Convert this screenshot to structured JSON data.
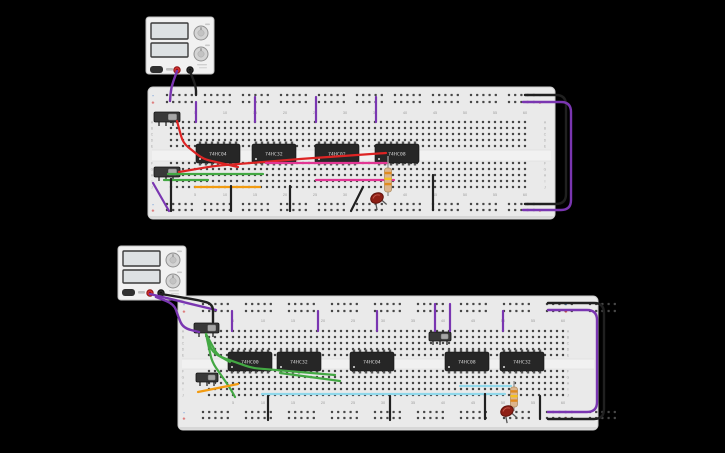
{
  "colors": {
    "background": "#000000",
    "board": "#eaeaea",
    "board_edge": "#cccccc",
    "board_shadow": "#d7d7d7",
    "hole": "#474747",
    "channel": "#f1f1f1",
    "channel_line": "#d8d8d8",
    "label_gray": "#9c9c9c",
    "letter_gray": "#a8a8a8",
    "rail_neg_blue": "#5b8fd6",
    "rail_pos_red": "#d64545",
    "ic_body": "#262626",
    "ic_pin": "#565656",
    "ic_text": "#dcdcdc",
    "switch_body": "#383838",
    "switch_slider": "#a6a6a6",
    "switch_pin": "#6a6a6a",
    "wire_purple": "#7a36b1",
    "wire_black": "#202020",
    "wire_red": "#dd2424",
    "wire_green": "#43a843",
    "wire_orange": "#f29b11",
    "wire_cyan": "#8fd7ea",
    "wire_magenta": "#e23694",
    "led_body": "#8e1f15",
    "led_stroke": "#5f120b",
    "led_shine": "#c05548",
    "resistor_body": "#dcb48c",
    "resistor_stroke": "#b08d5f",
    "band_orange": "#e08a1e",
    "band_yellow": "#f5c11e",
    "psu_body": "#f1f1f1",
    "psu_edge": "#c2c2c2",
    "psu_display": "#dde1e3",
    "psu_display_edge": "#3b3b3b",
    "psu_knob": "#d4d4d4",
    "psu_button": "#303030",
    "terminal_red": "#d32f2f",
    "terminal_black": "#2a2a2a"
  },
  "board_labels": {
    "columns": [
      5,
      10,
      15,
      20,
      25,
      30,
      35,
      40,
      45,
      50,
      55,
      60
    ],
    "rows": [
      "A",
      "B",
      "C",
      "D",
      "E",
      "F",
      "G",
      "H",
      "I",
      "J"
    ],
    "rail_negative": "-",
    "rail_positive": "+"
  },
  "power_supplies": [
    {
      "name": "power-supply-top",
      "x": 146,
      "y": 17,
      "w": 68,
      "h": 57,
      "displays": [
        {
          "x": 151,
          "y": 23,
          "w": 37,
          "h": 16
        },
        {
          "x": 151,
          "y": 43,
          "w": 37,
          "h": 14
        }
      ],
      "knobs": [
        {
          "cx": 201,
          "cy": 33,
          "r": 7
        },
        {
          "cx": 201,
          "cy": 54,
          "r": 7
        }
      ],
      "button": {
        "x": 150,
        "y": 66,
        "w": 13,
        "h": 7
      },
      "terminals": [
        {
          "cx": 177,
          "cy": 70,
          "type": "positive"
        },
        {
          "cx": 190,
          "cy": 70,
          "type": "negative"
        }
      ]
    },
    {
      "name": "power-supply-bottom",
      "x": 118,
      "y": 246,
      "w": 68,
      "h": 54,
      "displays": [
        {
          "x": 123,
          "y": 251,
          "w": 37,
          "h": 15
        },
        {
          "x": 123,
          "y": 270,
          "w": 37,
          "h": 13
        }
      ],
      "knobs": [
        {
          "cx": 173,
          "cy": 260,
          "r": 7
        },
        {
          "cx": 173,
          "cy": 281,
          "r": 7
        }
      ],
      "button": {
        "x": 122,
        "y": 289,
        "w": 13,
        "h": 7
      },
      "terminals": [
        {
          "cx": 150,
          "cy": 293,
          "type": "positive"
        },
        {
          "cx": 161,
          "cy": 293,
          "type": "negative"
        }
      ]
    }
  ],
  "breadboards": [
    {
      "name": "breadboard-top",
      "x": 148,
      "y": 87,
      "w": 407,
      "h": 132,
      "rail": {
        "x0": 167,
        "sp": 6.2,
        "gap": 7,
        "top_rows": [
          95,
          102
        ],
        "bottom_rows": [
          204,
          210
        ],
        "mark_left_x": 153,
        "mark_right_x": 540
      },
      "grid": {
        "x0": 171,
        "sp": 6,
        "cols": 60,
        "rows_top": [
          122,
          128,
          134,
          140,
          146
        ],
        "rows_bot": [
          163,
          169,
          175,
          181,
          187
        ],
        "num_y": [
          114,
          196
        ],
        "letters_x": [
          152,
          545
        ],
        "channel": [
          150,
          11
        ]
      },
      "ics": [
        {
          "label": "74HC04",
          "x": 196,
          "y": 144,
          "w": 44,
          "h": 19
        },
        {
          "label": "74HC32",
          "x": 252,
          "y": 144,
          "w": 44,
          "h": 19
        },
        {
          "label": "74HC02",
          "x": 315,
          "y": 144,
          "w": 44,
          "h": 19
        },
        {
          "label": "74HC08",
          "x": 375,
          "y": 144,
          "w": 44,
          "h": 19
        }
      ],
      "switches": [
        {
          "x": 154,
          "y": 112,
          "w": 26,
          "h": 10,
          "pins": [
            159,
            166,
            173
          ],
          "pin_y": 122
        },
        {
          "x": 154,
          "y": 167,
          "w": 26,
          "h": 10,
          "pins": [
            159,
            166,
            173
          ],
          "pin_y": 177
        }
      ],
      "leds": [
        {
          "cx": 377,
          "cy": 198,
          "rot": -25
        }
      ],
      "resistors": [
        {
          "x": 388,
          "lead_y1": 156,
          "lead_y2": 196,
          "body_y1": 168,
          "body_y2": 192
        }
      ]
    },
    {
      "name": "breadboard-bottom",
      "x": 178,
      "y": 296,
      "w": 420,
      "h": 134,
      "rail": {
        "x0": 203,
        "sp": 6.2,
        "gap": 12,
        "top_rows": [
          304,
          311
        ],
        "bottom_rows": [
          412,
          418
        ],
        "mark_left_x": 184,
        "mark_right_x": 566
      },
      "grid": {
        "x0": 209,
        "sp": 6,
        "cols": 60,
        "rows_top": [
          331,
          337,
          343,
          349,
          355
        ],
        "rows_bot": [
          371,
          377,
          383,
          389,
          395
        ],
        "num_y": [
          322,
          404
        ],
        "letters_x": [
          183,
          568
        ],
        "channel": [
          359,
          10
        ]
      },
      "ics": [
        {
          "label": "74HC00",
          "x": 228,
          "y": 352,
          "w": 44,
          "h": 19
        },
        {
          "label": "74HC32",
          "x": 277,
          "y": 352,
          "w": 44,
          "h": 19
        },
        {
          "label": "74HC04",
          "x": 350,
          "y": 352,
          "w": 44,
          "h": 19
        },
        {
          "label": "74HC08",
          "x": 445,
          "y": 352,
          "w": 44,
          "h": 19
        },
        {
          "label": "74HC32",
          "x": 500,
          "y": 352,
          "w": 44,
          "h": 19
        }
      ],
      "switches": [
        {
          "x": 194,
          "y": 323,
          "w": 25,
          "h": 10,
          "pins": [
            199,
            206,
            213
          ],
          "pin_y": 333
        },
        {
          "x": 196,
          "y": 373,
          "w": 22,
          "h": 9,
          "pins": [
            200,
            207,
            214
          ],
          "pin_y": 382
        },
        {
          "x": 429,
          "y": 332,
          "w": 22,
          "h": 9,
          "pins": [
            433,
            440,
            447
          ],
          "pin_y": 341
        }
      ],
      "leds": [
        {
          "cx": 507,
          "cy": 411,
          "rot": -25
        }
      ],
      "resistors": [
        {
          "x": 514,
          "lead_y1": 381,
          "lead_y2": 411,
          "body_y1": 387,
          "body_y2": 407
        }
      ]
    }
  ],
  "wires": [
    {
      "id": "psu1-positive",
      "color": "purple",
      "w": 2.4,
      "points": [
        [
          177,
          71
        ],
        [
          171,
          88
        ],
        [
          170,
          101
        ]
      ]
    },
    {
      "id": "psu1-negative",
      "color": "black",
      "w": 2.4,
      "points": [
        [
          190,
          71
        ],
        [
          196,
          87
        ],
        [
          196,
          95
        ]
      ]
    },
    {
      "id": "b1-rail-jumper-1",
      "color": "purple",
      "w": 2.2,
      "points": [
        [
          196,
          102
        ],
        [
          196,
          122
        ]
      ]
    },
    {
      "id": "b1-rail-jumper-2",
      "color": "purple",
      "w": 2.2,
      "points": [
        [
          255,
          97
        ],
        [
          255,
          122
        ]
      ]
    },
    {
      "id": "b1-rail-jumper-3",
      "color": "purple",
      "w": 2.2,
      "points": [
        [
          316,
          97
        ],
        [
          316,
          122
        ]
      ]
    },
    {
      "id": "b1-rail-jumper-4",
      "color": "purple",
      "w": 2.2,
      "points": [
        [
          376,
          97
        ],
        [
          376,
          122
        ]
      ]
    },
    {
      "id": "b1-red-1",
      "color": "red",
      "w": 2.2,
      "points": [
        [
          177,
          121
        ],
        [
          183,
          143
        ],
        [
          203,
          159
        ],
        [
          238,
          167
        ]
      ]
    },
    {
      "id": "b1-red-2",
      "color": "red",
      "w": 2.2,
      "points": [
        [
          179,
          172
        ],
        [
          214,
          166
        ],
        [
          300,
          159
        ],
        [
          386,
          153
        ]
      ]
    },
    {
      "id": "b1-magenta-1",
      "color": "magenta",
      "w": 2.2,
      "points": [
        [
          266,
          163
        ],
        [
          388,
          163
        ]
      ]
    },
    {
      "id": "b1-magenta-2",
      "color": "magenta",
      "w": 2.2,
      "points": [
        [
          316,
          180
        ],
        [
          394,
          180
        ]
      ]
    },
    {
      "id": "b1-green-1",
      "color": "green",
      "w": 2.2,
      "points": [
        [
          168,
          174
        ],
        [
          263,
          174
        ]
      ]
    },
    {
      "id": "b1-green-2",
      "color": "green",
      "w": 2.2,
      "points": [
        [
          164,
          180
        ],
        [
          208,
          180
        ]
      ]
    },
    {
      "id": "b1-orange",
      "color": "orange",
      "w": 2.2,
      "points": [
        [
          195,
          187
        ],
        [
          260,
          187
        ]
      ]
    },
    {
      "id": "b1-black-1",
      "color": "black",
      "w": 2.2,
      "points": [
        [
          171,
          179
        ],
        [
          171,
          211
        ]
      ]
    },
    {
      "id": "b1-black-2",
      "color": "black",
      "w": 2.2,
      "points": [
        [
          231,
          186
        ],
        [
          231,
          211
        ]
      ]
    },
    {
      "id": "b1-black-3",
      "color": "black",
      "w": 2.2,
      "points": [
        [
          290,
          186
        ],
        [
          290,
          211
        ]
      ]
    },
    {
      "id": "b1-black-4",
      "color": "black",
      "w": 2.2,
      "points": [
        [
          433,
          175
        ],
        [
          433,
          210
        ]
      ]
    },
    {
      "id": "b1-black-5",
      "color": "black",
      "w": 2.2,
      "points": [
        [
          363,
          187
        ],
        [
          351,
          211
        ]
      ]
    },
    {
      "id": "b1-purple-diag",
      "color": "purple",
      "w": 2.2,
      "points": [
        [
          153,
          183
        ],
        [
          169,
          211
        ]
      ]
    },
    {
      "id": "b1-wrap-black",
      "color": "black",
      "w": 2.4,
      "r": 10,
      "points": [
        [
          525,
          95
        ],
        [
          566,
          95
        ],
        [
          566,
          204
        ],
        [
          525,
          204
        ]
      ]
    },
    {
      "id": "b1-wrap-purple",
      "color": "purple",
      "w": 2.4,
      "r": 10,
      "points": [
        [
          523,
          102
        ],
        [
          571,
          102
        ],
        [
          571,
          210
        ],
        [
          523,
          210
        ]
      ]
    },
    {
      "id": "psu2-positive",
      "color": "purple",
      "w": 2.4,
      "points": [
        [
          150,
          294
        ],
        [
          183,
          302
        ],
        [
          216,
          310
        ]
      ]
    },
    {
      "id": "psu2-negative",
      "color": "black",
      "w": 2.4,
      "points": [
        [
          161,
          294
        ],
        [
          198,
          300
        ],
        [
          213,
          304
        ],
        [
          213,
          322
        ]
      ]
    },
    {
      "id": "psu2-loop",
      "color": "purple",
      "w": 2.4,
      "r": 9,
      "points": [
        [
          156,
          297
        ],
        [
          174,
          304
        ],
        [
          178,
          316
        ],
        [
          183,
          328
        ],
        [
          199,
          332
        ]
      ]
    },
    {
      "id": "b2-rail-jumper-1",
      "color": "purple",
      "w": 2.2,
      "points": [
        [
          232,
          311
        ],
        [
          232,
          331
        ]
      ]
    },
    {
      "id": "b2-rail-jumper-2",
      "color": "purple",
      "w": 2.2,
      "points": [
        [
          318,
          311
        ],
        [
          318,
          331
        ]
      ]
    },
    {
      "id": "b2-rail-jumper-3",
      "color": "purple",
      "w": 2.2,
      "points": [
        [
          377,
          311
        ],
        [
          377,
          331
        ]
      ]
    },
    {
      "id": "b2-rail-jumper-4",
      "color": "purple",
      "w": 2.2,
      "points": [
        [
          435,
          304
        ],
        [
          435,
          331
        ]
      ]
    },
    {
      "id": "b2-rail-jumper-5",
      "color": "purple",
      "w": 2.2,
      "points": [
        [
          450,
          304
        ],
        [
          450,
          331
        ]
      ]
    },
    {
      "id": "b2-rail-jumper-6",
      "color": "purple",
      "w": 2.2,
      "points": [
        [
          503,
          311
        ],
        [
          503,
          331
        ]
      ]
    },
    {
      "id": "b2-green-1",
      "color": "green",
      "w": 2.2,
      "points": [
        [
          206,
          334
        ],
        [
          212,
          352
        ],
        [
          230,
          362
        ]
      ]
    },
    {
      "id": "b2-green-2",
      "color": "green",
      "w": 2.2,
      "points": [
        [
          206,
          334
        ],
        [
          218,
          356
        ],
        [
          252,
          368
        ],
        [
          335,
          375
        ]
      ]
    },
    {
      "id": "b2-green-3",
      "color": "green",
      "w": 2.2,
      "points": [
        [
          206,
          334
        ],
        [
          212,
          362
        ],
        [
          230,
          388
        ],
        [
          235,
          397
        ]
      ]
    },
    {
      "id": "b2-green-4",
      "color": "green",
      "w": 2.2,
      "points": [
        [
          280,
          373
        ],
        [
          340,
          381
        ]
      ]
    },
    {
      "id": "b2-orange",
      "color": "orange",
      "w": 2.2,
      "points": [
        [
          198,
          392
        ],
        [
          238,
          384
        ]
      ]
    },
    {
      "id": "b2-cyan-1",
      "color": "cyan",
      "w": 2.2,
      "points": [
        [
          262,
          394
        ],
        [
          505,
          394
        ]
      ]
    },
    {
      "id": "b2-cyan-2",
      "color": "cyan",
      "w": 2.2,
      "points": [
        [
          460,
          386
        ],
        [
          511,
          386
        ]
      ]
    },
    {
      "id": "b2-black-1",
      "color": "black",
      "w": 2.2,
      "points": [
        [
          268,
          396
        ],
        [
          268,
          420
        ]
      ]
    },
    {
      "id": "b2-black-2",
      "color": "black",
      "w": 2.2,
      "points": [
        [
          390,
          396
        ],
        [
          390,
          420
        ]
      ]
    },
    {
      "id": "b2-black-3",
      "color": "black",
      "w": 2.2,
      "points": [
        [
          485,
          394
        ],
        [
          485,
          419
        ]
      ]
    },
    {
      "id": "b2-black-4",
      "color": "black",
      "w": 2.2,
      "points": [
        [
          540,
          396
        ],
        [
          540,
          419
        ]
      ]
    },
    {
      "id": "b2-wrap-black",
      "color": "black",
      "w": 2.4,
      "r": 10,
      "points": [
        [
          548,
          303
        ],
        [
          604,
          303
        ],
        [
          604,
          419
        ],
        [
          548,
          419
        ]
      ]
    },
    {
      "id": "b2-wrap-purple",
      "color": "purple",
      "w": 2.4,
      "r": 10,
      "points": [
        [
          548,
          310
        ],
        [
          597,
          310
        ],
        [
          597,
          412
        ],
        [
          548,
          412
        ]
      ]
    }
  ]
}
